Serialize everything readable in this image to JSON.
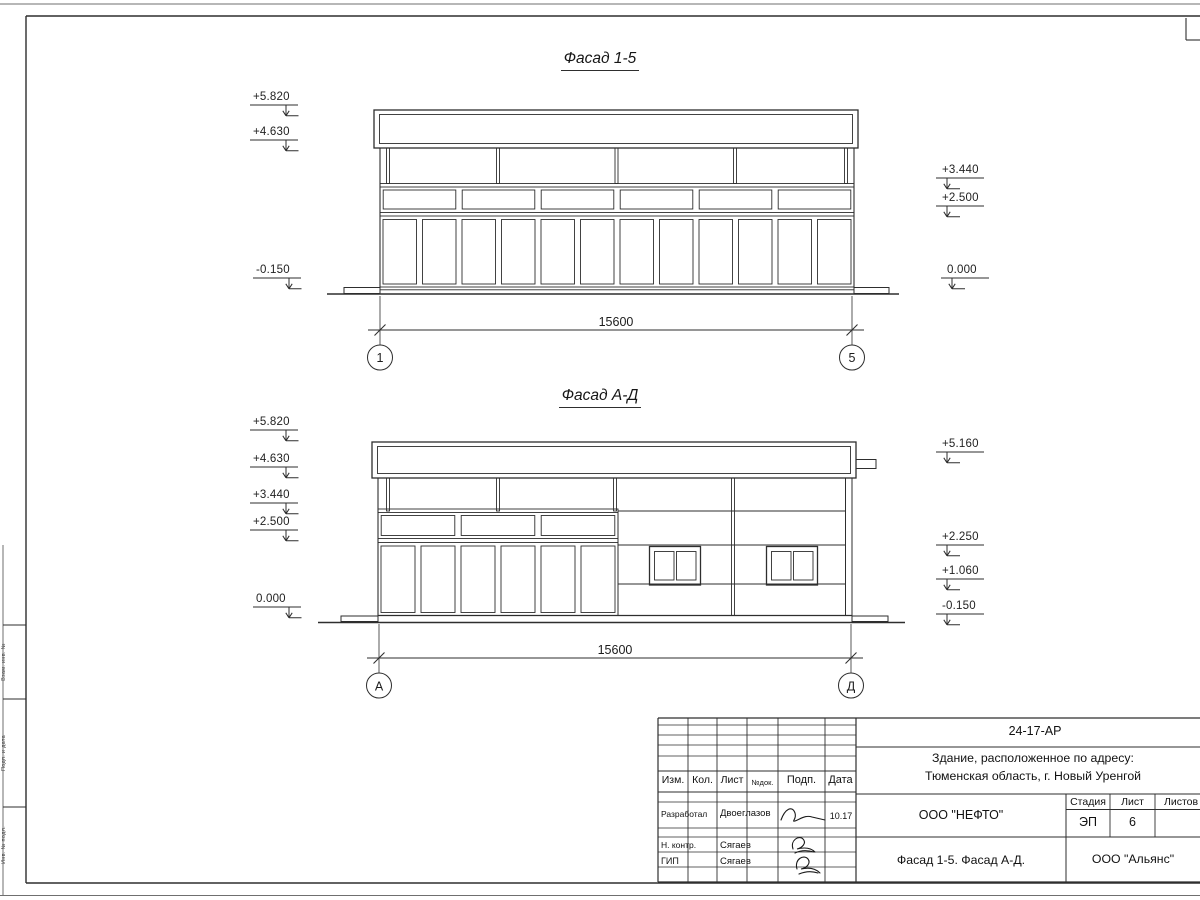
{
  "facade_top": {
    "title": "Фасад 1-5",
    "dimension": "15600",
    "axes": [
      "1",
      "5"
    ],
    "elevations_left": [
      "+5.820",
      "+4.630",
      "-0.150"
    ],
    "elevations_right": [
      "+3.440",
      "+2.500",
      "0.000"
    ]
  },
  "facade_bottom": {
    "title": "Фасад А-Д",
    "dimension": "15600",
    "axes": [
      "А",
      "Д"
    ],
    "elevations_left": [
      "+5.820",
      "+4.630",
      "+3.440",
      "+2.500",
      "0.000"
    ],
    "elevations_right": [
      "+5.160",
      "+2.250",
      "+1.060",
      "-0.150"
    ]
  },
  "title_block": {
    "doc_number": "24-17-АР",
    "project_line1": "Здание, расположенное по адресу:",
    "project_line2": "Тюменская область, г. Новый Уренгой",
    "columns": [
      "Изм.",
      "Кол.",
      "Лист",
      "№док.",
      "Подп.",
      "Дата"
    ],
    "row_developer_role": "Разработал",
    "row_developer_name": "Двоеглазов",
    "row_developer_date": "10.17",
    "row_ncontrol_role": "Н. контр.",
    "row_ncontrol_name": "Сягаев",
    "row_gip_role": "ГИП",
    "row_gip_name": "Сягаев",
    "customer": "ООО \"НЕФТО\"",
    "stage_label": "Стадия",
    "stage_value": "ЭП",
    "sheet_label": "Лист",
    "sheet_value": "6",
    "sheets_label": "Листов",
    "sheet_title": "Фасад 1-5. Фасад А-Д.",
    "company": "ООО \"Альянс\"",
    "line_color": "#2e2e2e"
  },
  "margin_stamp": {
    "labels": [
      "Взам. инв. №",
      "Подп. и дата",
      "Инв. № подл."
    ]
  }
}
